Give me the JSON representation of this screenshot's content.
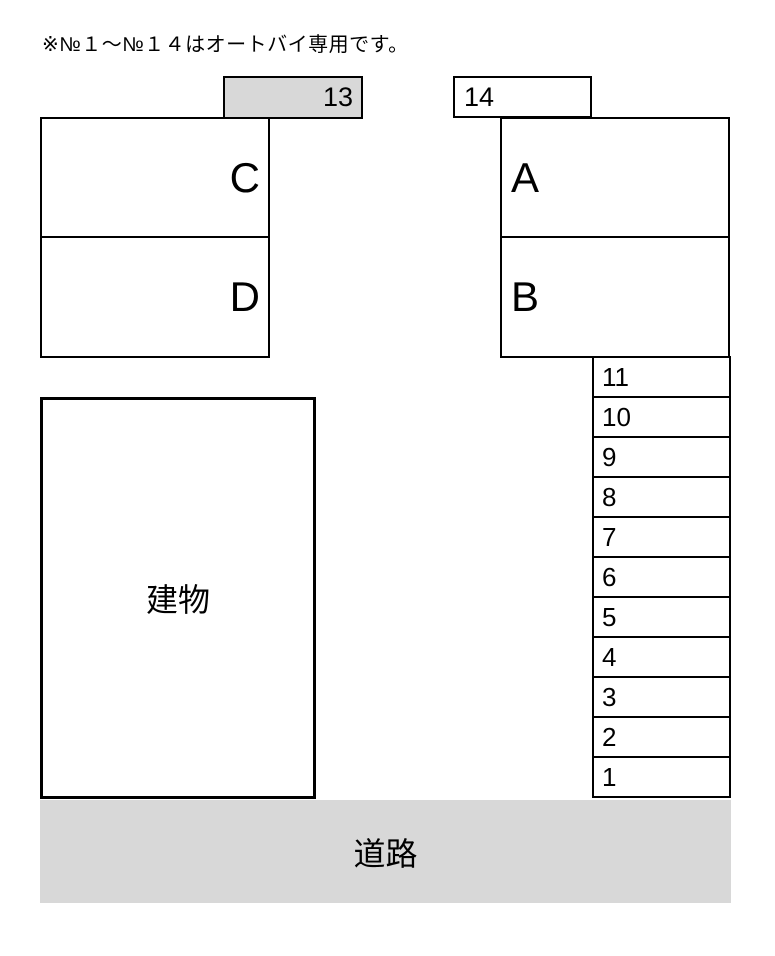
{
  "note": "※№１～№１４はオートバイ専用です。",
  "colors": {
    "border": "#000000",
    "background": "#ffffff",
    "reserved_spot_fill": "#d8d8d8",
    "road_fill": "#d8d8d8"
  },
  "spots": {
    "spot_13": {
      "label": "13"
    },
    "spot_14": {
      "label": "14"
    },
    "spot_a": {
      "label": "A"
    },
    "spot_b": {
      "label": "B"
    },
    "spot_c": {
      "label": "C"
    },
    "spot_d": {
      "label": "D"
    },
    "column": [
      {
        "label": "11"
      },
      {
        "label": "10"
      },
      {
        "label": "9"
      },
      {
        "label": "8"
      },
      {
        "label": "7"
      },
      {
        "label": "6"
      },
      {
        "label": "5"
      },
      {
        "label": "4"
      },
      {
        "label": "3"
      },
      {
        "label": "2"
      },
      {
        "label": "1"
      }
    ]
  },
  "building": {
    "label": "建物"
  },
  "road": {
    "label": "道路"
  }
}
